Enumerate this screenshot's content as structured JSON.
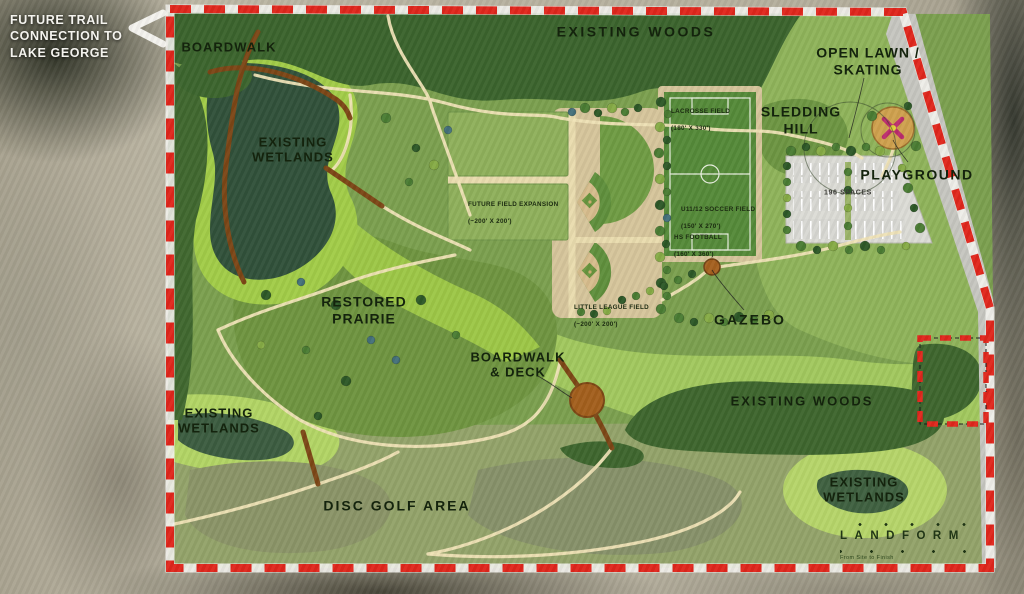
{
  "annotations": {
    "future_trail_note": "FUTURE TRAIL\nCONNECTION TO\nLAKE GEORGE"
  },
  "areas": {
    "boardwalk": "BOARDWALK",
    "existing_woods_north": "EXISTING WOODS",
    "open_lawn_skating": "OPEN LAWN /\nSKATING",
    "sledding_hill": "SLEDDING\nHILL",
    "existing_wetlands_northwest": "EXISTING\nWETLANDS",
    "playground": "PLAYGROUND",
    "restored_prairie": "RESTORED\nPRAIRIE",
    "gazebo": "GAZEBO",
    "boardwalk_deck": "BOARDWALK\n& DECK",
    "existing_woods_east": "EXISTING WOODS",
    "existing_wetlands_southwest": "EXISTING\nWETLANDS",
    "disc_golf_area": "DISC GOLF AREA",
    "existing_wetlands_southeast": "EXISTING\nWETLANDS"
  },
  "facilities": {
    "lacrosse": {
      "name": "LACROSSE FIELD",
      "dims": "(180' X 330')"
    },
    "future_expansion": {
      "name": "FUTURE FIELD EXPANSION",
      "dims": "(~200' X 200')"
    },
    "soccer": {
      "name": "U11/12 SOCCER FIELD",
      "dims": "(150' X 270')"
    },
    "football": {
      "name": "HS FOOTBALL",
      "dims": "(160' X 360')"
    },
    "little_league": {
      "name": "LITTLE LEAGUE FIELD",
      "dims": "(~200' X 200')"
    },
    "parking": "196 SPACES"
  },
  "logo": {
    "wordmark": "LANDFORM",
    "tagline": "From Site to Finish"
  },
  "colors": {
    "boundary": "#e0261c",
    "woods": "#3b642d",
    "marsh": "#a2cc48",
    "ink": "#14230d"
  }
}
